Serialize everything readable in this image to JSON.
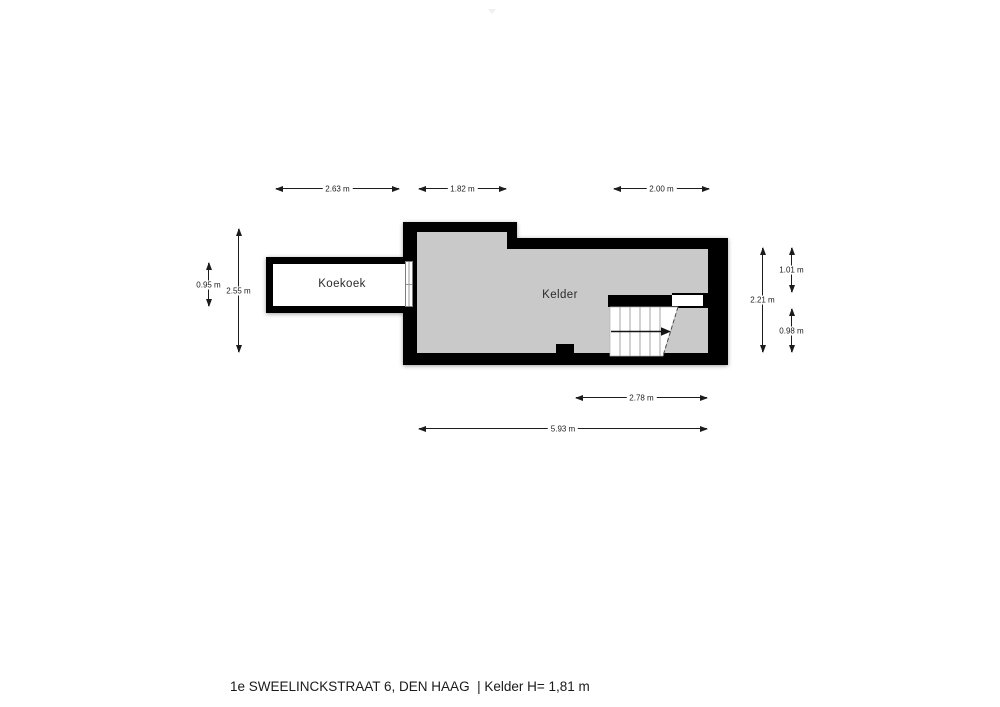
{
  "page": {
    "background_color": "#ffffff",
    "footer_title": "1e SWEELINCKSTRAAT 6, DEN HAAG  | Kelder H= 1,81 m"
  },
  "floorplan": {
    "wall_color": "#000000",
    "rooms": {
      "koekoek": {
        "label": "Koekoek",
        "floor_color": "#ffffff"
      },
      "kelder": {
        "label": "Kelder",
        "floor_color": "#c9c9c9"
      }
    },
    "dimensions": {
      "top": [
        {
          "label": "2.63 m"
        },
        {
          "label": "1.82 m"
        },
        {
          "label": "2.00 m"
        }
      ],
      "bottom": [
        {
          "label": "2.78 m"
        },
        {
          "label": "5.93 m"
        }
      ],
      "left": [
        {
          "label": "0.95 m"
        },
        {
          "label": "2.55 m"
        }
      ],
      "right": [
        {
          "label": "2.21 m"
        },
        {
          "label": "1.01 m"
        },
        {
          "label": "0.98 m"
        }
      ]
    }
  }
}
